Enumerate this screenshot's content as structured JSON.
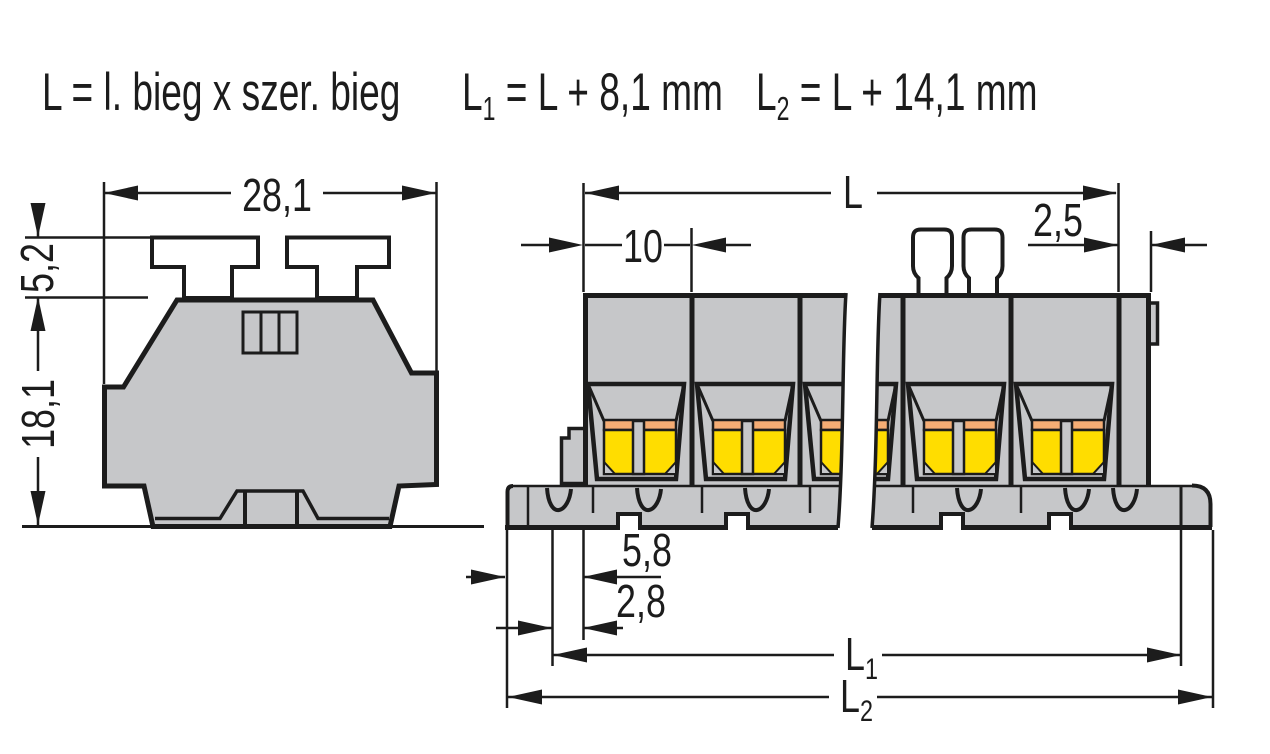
{
  "formula": {
    "part1": "L = l. bieg x szer. bieg",
    "part2_base": "L",
    "part2_sub": "1",
    "part2_rest": " = L + 8,1 mm",
    "part3_base": "L",
    "part3_sub": "2",
    "part3_rest": " = L + 14,1 mm"
  },
  "side_view": {
    "width": "28,1",
    "upper_height": "5,2",
    "lower_height": "18,1"
  },
  "front_view": {
    "total_length": "L",
    "pole_pitch": "10",
    "end_plate": "2,5",
    "foot_outer": "5,8",
    "foot_inner": "2,8",
    "l1_base": "L",
    "l1_sub": "1",
    "l2_base": "L",
    "l2_sub": "2"
  },
  "colors": {
    "background": "#ffffff",
    "body-gray": "#c6c7c9",
    "outline": "#1c1c1c",
    "clamp-yellow": "#ffdd00",
    "clamp-orange": "#f5ad74"
  }
}
